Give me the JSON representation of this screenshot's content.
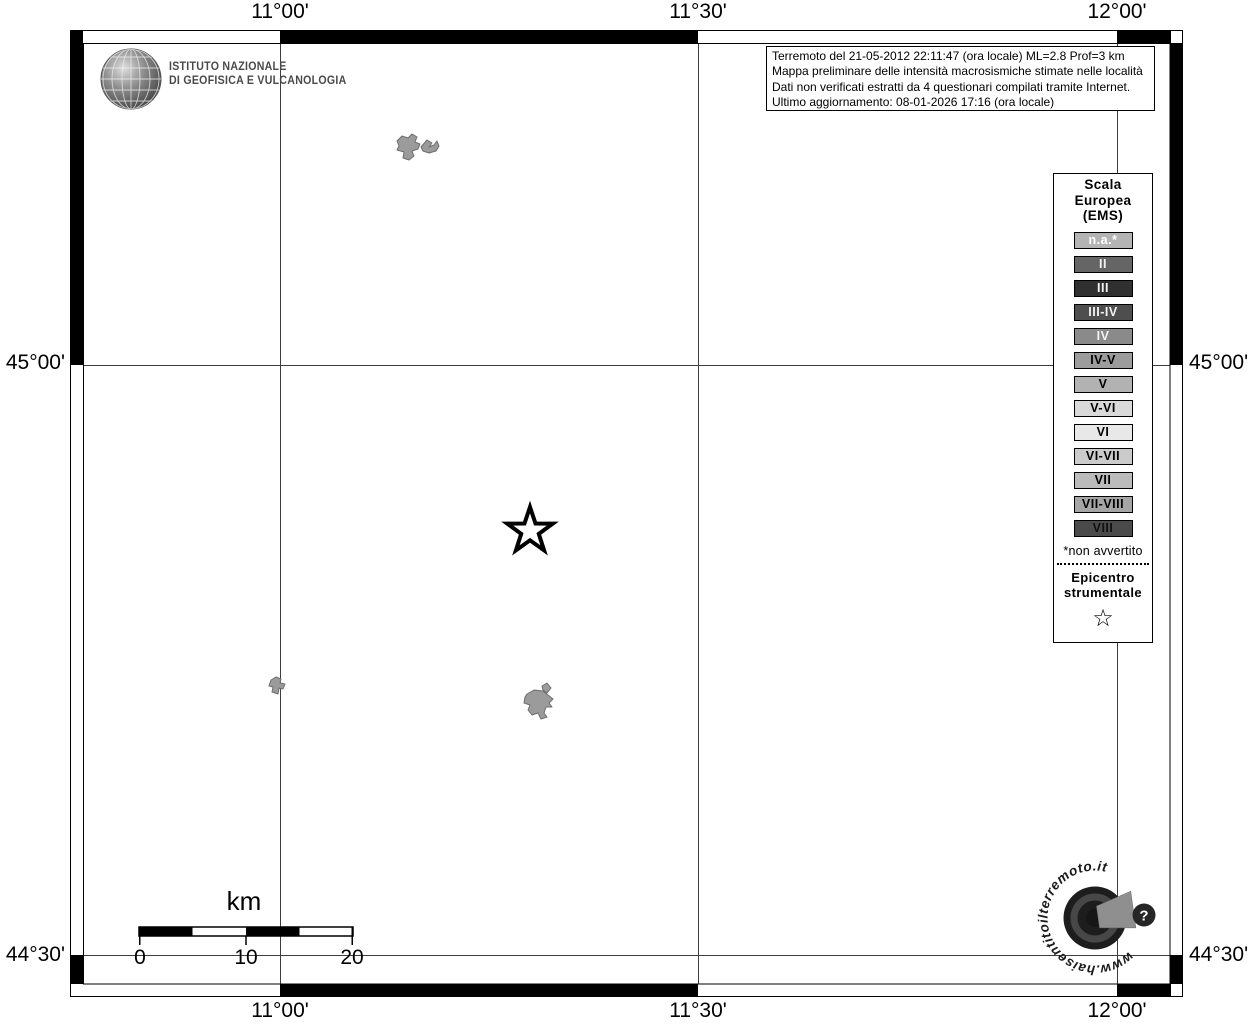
{
  "branding": {
    "institute_line1": "ISTITUTO NAZIONALE",
    "institute_line2": "DI GEOFISICA E VULCANOLOGIA"
  },
  "info_box": {
    "line1": "Terremoto del 21-05-2012 22:11:47 (ora locale) ML=2.8 Prof=3 km",
    "line2": "Mappa preliminare delle intensità macrosismiche stimate nelle località",
    "line3": "Dati non verificati estratti da 4 questionari compilati tramite Internet.",
    "line4": "Ultimo aggiornamento: 08-01-2026 17:16 (ora locale)"
  },
  "axes": {
    "top": [
      "11°00'",
      "11°30'",
      "12°00'"
    ],
    "bottom": [
      "11°00'",
      "11°30'",
      "12°00'"
    ],
    "left": [
      "45°00'",
      "44°30'"
    ],
    "right": [
      "45°00'",
      "44°30'"
    ]
  },
  "legend": {
    "title_line1": "Scala",
    "title_line2": "Europea",
    "title_line3": "(EMS)",
    "items": [
      {
        "label": "n.a.*",
        "bg": "#b4b4b4",
        "fg": "#ffffff"
      },
      {
        "label": "II",
        "bg": "#656565",
        "fg": "#f2f2f2"
      },
      {
        "label": "III",
        "bg": "#303030",
        "fg": "#f2f2f2"
      },
      {
        "label": "III-IV",
        "bg": "#4e4e4e",
        "fg": "#f2f2f2"
      },
      {
        "label": "IV",
        "bg": "#8a8a8a",
        "fg": "#f2f2f2"
      },
      {
        "label": "IV-V",
        "bg": "#9c9c9c",
        "fg": "#000000"
      },
      {
        "label": "V",
        "bg": "#b2b2b2",
        "fg": "#000000"
      },
      {
        "label": "V-VI",
        "bg": "#d9d9d9",
        "fg": "#000000"
      },
      {
        "label": "VI",
        "bg": "#e8e8e8",
        "fg": "#000000"
      },
      {
        "label": "VI-VII",
        "bg": "#cbcbcb",
        "fg": "#000000"
      },
      {
        "label": "VII",
        "bg": "#bbbbbb",
        "fg": "#000000"
      },
      {
        "label": "VII-VIII",
        "bg": "#a5a5a5",
        "fg": "#000000"
      },
      {
        "label": "VIII",
        "bg": "#4a4a4a",
        "fg": "#101010"
      }
    ],
    "footnote": "*non avvertito",
    "epicenter_line1": "Epicentro",
    "epicenter_line2": "strumentale",
    "epicenter_symbol": "☆"
  },
  "scale_bar": {
    "unit": "km",
    "tick_labels": [
      "0",
      "10",
      "20"
    ]
  },
  "watermark": {
    "text": "www.haisentitoilterremoto.it",
    "button": "?"
  }
}
